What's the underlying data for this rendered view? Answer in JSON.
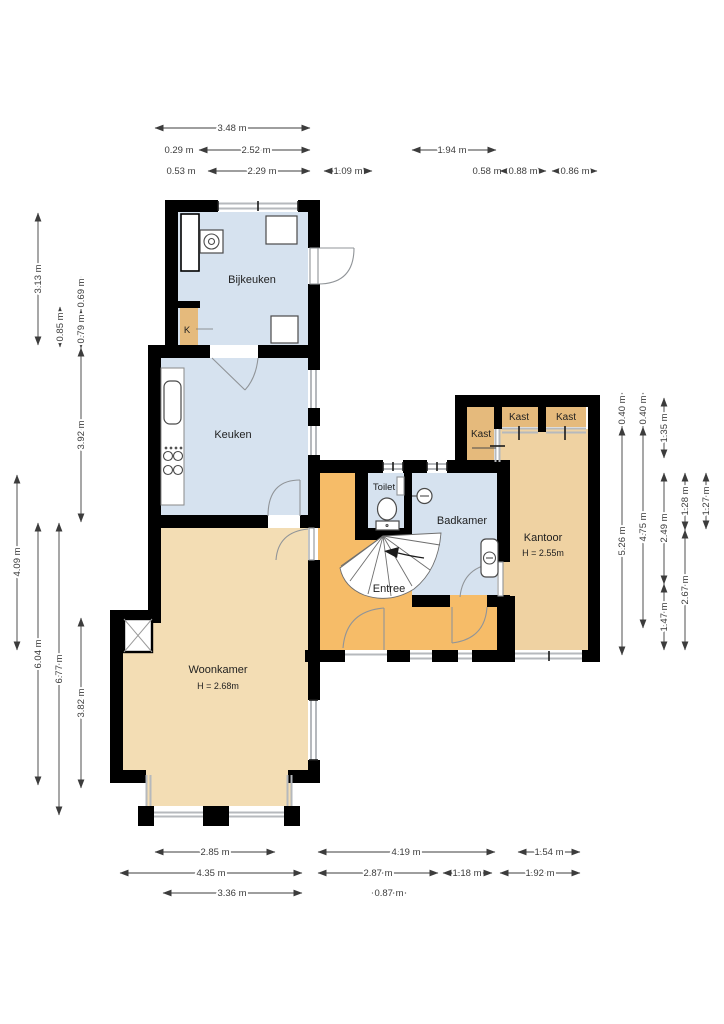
{
  "plan_type": "floorplan",
  "rooms": {
    "bijkeuken": {
      "label": "Bijkeuken"
    },
    "keuken": {
      "label": "Keuken"
    },
    "woonkamer": {
      "label": "Woonkamer",
      "height": "H = 2.68m"
    },
    "entree": {
      "label": "Entree"
    },
    "toilet": {
      "label": "Toilet"
    },
    "badkamer": {
      "label": "Badkamer"
    },
    "kantoor": {
      "label": "Kantoor",
      "height": "H = 2.55m"
    },
    "kast": {
      "label": "Kast"
    },
    "k_closet": {
      "label": "K"
    }
  },
  "dimensions": {
    "top": [
      "3.48 m",
      "0.29 m",
      "2.52 m",
      "1.94 m",
      "0.53 m",
      "2.29 m",
      "1.09 m",
      "0.58 m",
      "0.88 m",
      "0.86 m"
    ],
    "left": [
      "3.13 m",
      "0.85 m",
      "0.69 m",
      "0.79 m",
      "3.92 m",
      "4.09 m",
      "6.04 m",
      "6.77 m",
      "3.82 m"
    ],
    "right": [
      "0.40 m",
      "5.26 m",
      "0.40 m",
      "4.75 m",
      "1.35 m",
      "2.49 m",
      "1.47 m",
      "1.28 m",
      "2.67 m",
      "1.27 m"
    ],
    "bottom": [
      "2.85 m",
      "4.19 m",
      "1.54 m",
      "4.35 m",
      "2.87 m",
      "1.18 m",
      "1.92 m",
      "3.36 m",
      "0.87 m"
    ]
  },
  "colors": {
    "wall": "#000000",
    "room-blue": "#d6e2ef",
    "room-tan-light": "#f3ddb4",
    "room-tan": "#efd2a2",
    "kast-tan": "#e5ba7c",
    "entree-orange": "#f6bc68",
    "window-gray": "#b6b9bd",
    "door-gray": "#909498",
    "dim-color": "#3c3c3c"
  }
}
